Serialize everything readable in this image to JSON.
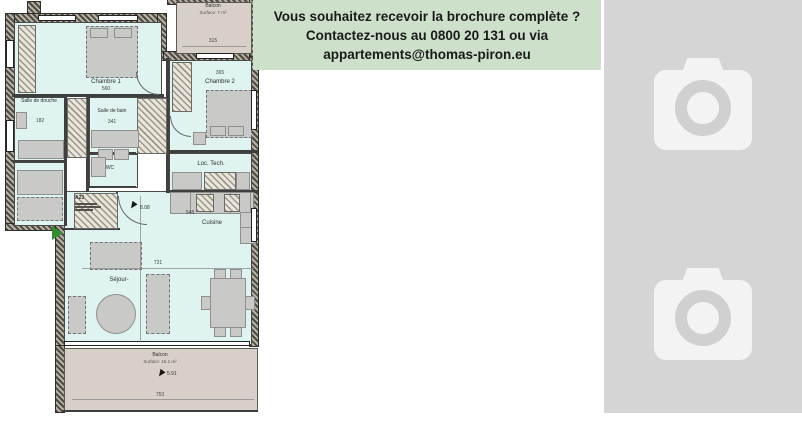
{
  "banner": {
    "lines": [
      "Vous souhaitez recevoir la brochure complète ?",
      "Contactez-nous au 0800 20 131 ou via",
      "appartements@thomas-piron.eu"
    ]
  },
  "floorplan": {
    "unit": "A23",
    "balcony_top": {
      "name": "Balcon",
      "surface": "Surface: 7 m²",
      "width_dim": "315"
    },
    "chambre1": {
      "name": "Chambre 1",
      "width_dim": "560"
    },
    "chambre2": {
      "name": "Chambre 2",
      "width_dim": "365"
    },
    "salle_de_douche": {
      "name": "Salle de douche",
      "width_dim": "182"
    },
    "salle_de_bain": {
      "name": "Salle de bain",
      "width_dim": "341"
    },
    "wc": {
      "name": "WC"
    },
    "loc_tech": {
      "name": "Loc. Tech."
    },
    "cuisine": {
      "name": "Cuisine",
      "width_dim": "548"
    },
    "sejour": {
      "name": "Séjour-",
      "width_dim": "721"
    },
    "balcony_bottom": {
      "name": "Balcon",
      "surface": "Surface: 15.1 m²",
      "width_dim": "753",
      "depth_dim": "5.91"
    },
    "hall_door_dim": "8.08"
  },
  "gallery": {
    "placeholder_count": 2,
    "icon": "camera"
  },
  "colors": {
    "banner_bg": "#cde0ca",
    "room_fill": "#dff3f1",
    "balcony_fill": "#d8d0c8",
    "panel_bg": "#d5d5d5",
    "accent_green": "#2f8f2f"
  }
}
